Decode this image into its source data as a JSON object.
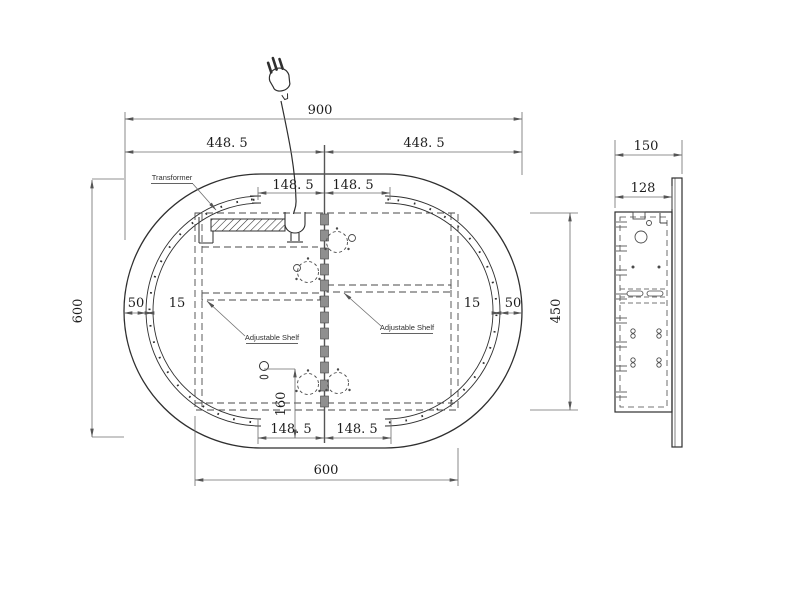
{
  "front_view": {
    "labels": {
      "transformer": "Transformer",
      "adjustable_shelf_left": "Adjustable Shelf",
      "adjustable_shelf_right": "Adjustable Shelf"
    },
    "dimensions": {
      "width_total": "900",
      "width_left": "448. 5",
      "width_right": "448. 5",
      "top_inner_left": "148. 5",
      "top_inner_right": "148. 5",
      "bottom_inner_left": "148. 5",
      "bottom_inner_right": "148. 5",
      "height_total": "600",
      "bottom_width": "600",
      "border_left": "50",
      "led_strip_left": "15",
      "led_strip_right": "15",
      "border_right": "50",
      "hinge_offset": "160"
    }
  },
  "side_view": {
    "dimensions": {
      "depth_total": "150",
      "cabinet_depth": "128",
      "cabinet_height": "450"
    }
  },
  "colors": {
    "object_line": "#2f2f2f",
    "dimension_line": "#6d6d6d",
    "text": "#1c1c1c",
    "hinge_fill": "#8f8f8f",
    "background": "#ffffff"
  }
}
